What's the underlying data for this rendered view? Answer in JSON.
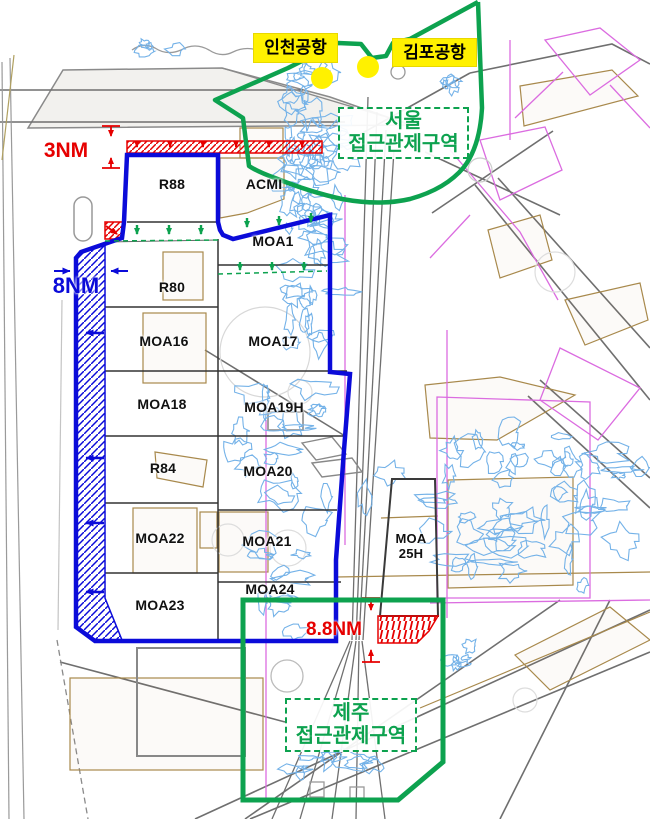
{
  "map": {
    "title": "Korean airspace sectors with Seoul and Jeju approach control areas",
    "airports": [
      {
        "label": "인천공항"
      },
      {
        "label": "김포공항"
      }
    ],
    "control_areas": [
      {
        "name": "seoul",
        "line1": "서울",
        "line2": "접근관제구역"
      },
      {
        "name": "jeju",
        "line1": "제주",
        "line2": "접근관제구역"
      }
    ],
    "zones": [
      {
        "label": "R88"
      },
      {
        "label": "ACMI"
      },
      {
        "label": "MOA1"
      },
      {
        "label": "R80"
      },
      {
        "label": "MOA16"
      },
      {
        "label": "MOA17"
      },
      {
        "label": "MOA18"
      },
      {
        "label": "MOA19H"
      },
      {
        "label": "R84"
      },
      {
        "label": "MOA20"
      },
      {
        "label": "MOA22"
      },
      {
        "label": "MOA21"
      },
      {
        "label": "MOA24"
      },
      {
        "label": "MOA23"
      },
      {
        "line1": "MOA",
        "line2": "25H"
      }
    ],
    "measurements": [
      {
        "label": "3NM"
      },
      {
        "label": "8NM"
      },
      {
        "label": "8.8NM"
      }
    ],
    "colors": {
      "boundary_blue": "#0b0bd9",
      "approach_green": "#0da24f",
      "buffer_red": "#e60000",
      "airport_yellow": "#fff100",
      "coast_blue": "#74b2e8",
      "chart_tan": "#a8894c",
      "chart_magenta": "#db6ce0",
      "chart_gray": "#777777"
    }
  }
}
